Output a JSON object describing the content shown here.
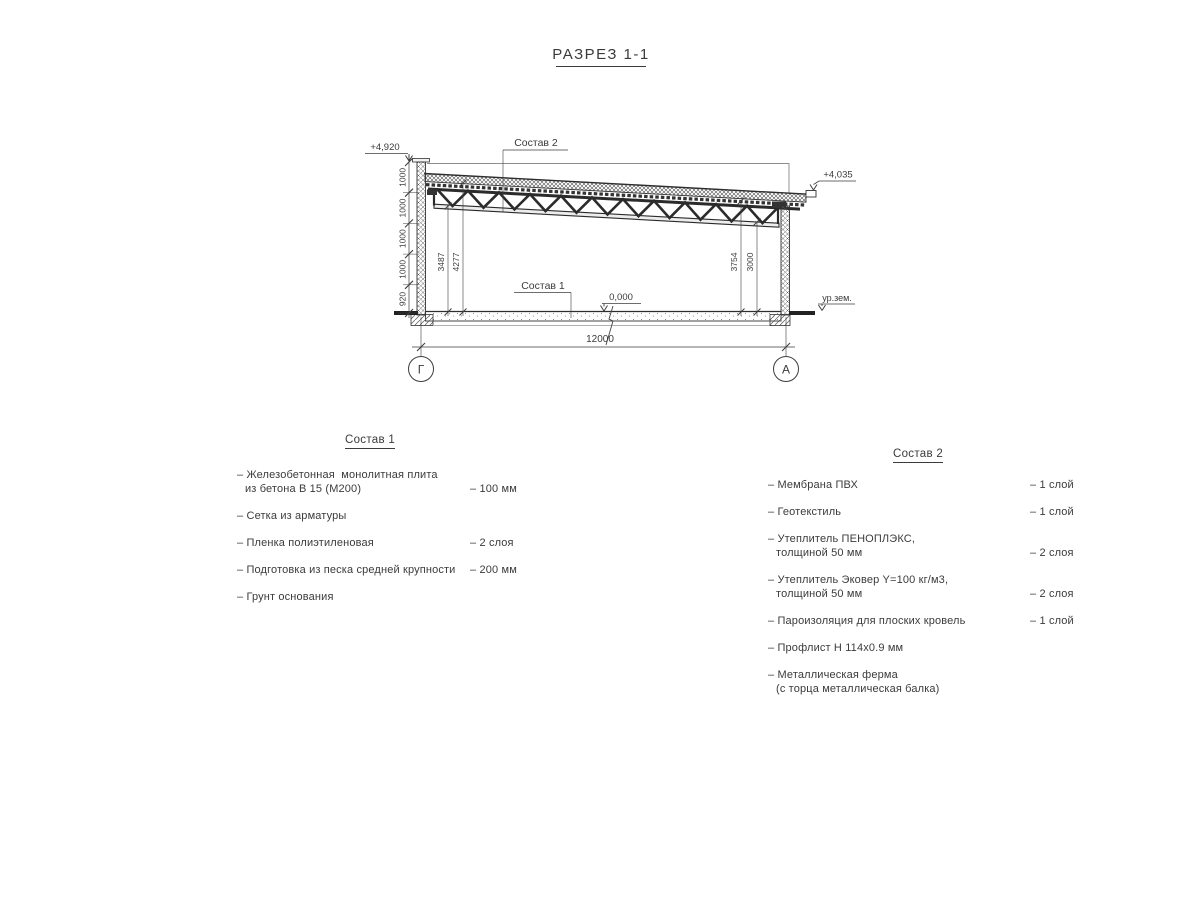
{
  "title": "РАЗРЕЗ 1-1",
  "section": {
    "callout_roof": "Состав 2",
    "callout_floor": "Состав 1",
    "elev_parapet": "+4,920",
    "elev_roof_edge": "+4,035",
    "elev_floor": "0,000",
    "ground_level": "ур.зем.",
    "span": "12000",
    "axis_left": "Г",
    "axis_right": "А",
    "wall_dims": [
      "1000",
      "1000",
      "1000",
      "1000",
      "920"
    ],
    "h_left_inner": "3487",
    "h_left_outer": "4277",
    "h_right_outer": "3754",
    "h_right_inner": "3000"
  },
  "composition1": {
    "heading": "Состав 1",
    "items": [
      {
        "name": "– Железобетонная  монолитная плита",
        "name2": "из бетона В 15 (М200)",
        "value": "– 100 мм"
      },
      {
        "name": "– Сетка из арматуры",
        "name2": "",
        "value": ""
      },
      {
        "name": "– Пленка полиэтиленовая",
        "name2": "",
        "value": "– 2 слоя"
      },
      {
        "name": "– Подготовка из песка средней крупности",
        "name2": "",
        "value": "– 200 мм"
      },
      {
        "name": "– Грунт основания",
        "name2": "",
        "value": ""
      }
    ]
  },
  "composition2": {
    "heading": "Состав 2",
    "items": [
      {
        "name": "– Мембрана ПВХ",
        "name2": "",
        "value": "– 1 слой"
      },
      {
        "name": "– Геотекстиль",
        "name2": "",
        "value": "– 1 слой"
      },
      {
        "name": "– Утеплитель ПЕНОПЛЭКС,",
        "name2": "толщиной 50 мм",
        "value": "– 2 слоя"
      },
      {
        "name": "– Утеплитель Эковер Y=100 кг/м3,",
        "name2": "толщиной 50 мм",
        "value": "– 2 слоя"
      },
      {
        "name": "– Пароизоляция для плоских кровель",
        "name2": "",
        "value": "– 1 слой"
      },
      {
        "name": "– Профлист Н 114х0.9 мм",
        "name2": "",
        "value": ""
      },
      {
        "name": "– Металлическая ферма",
        "name2": "(с торца металлическая балка)",
        "value": ""
      }
    ]
  }
}
